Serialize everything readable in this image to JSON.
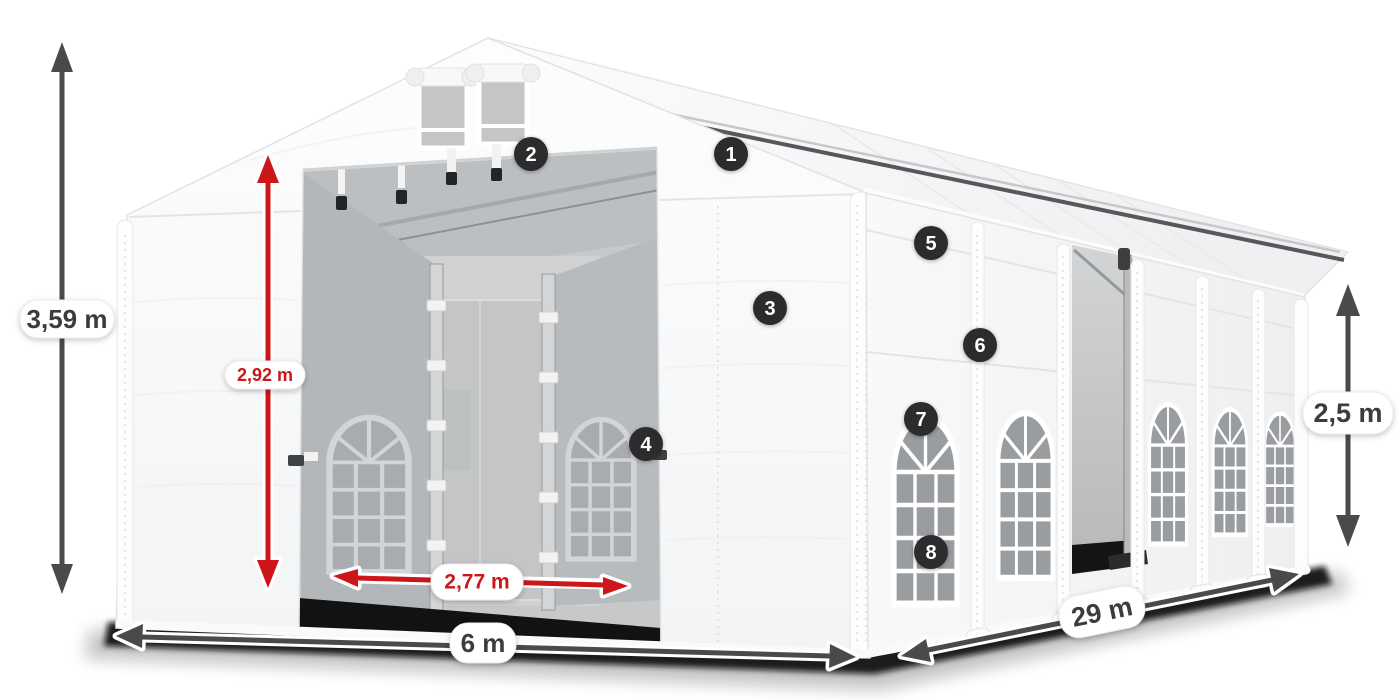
{
  "colors": {
    "accent-red": "#cc1619",
    "dim-dark": "#4a4a4d",
    "label-text": "#3c3c3c",
    "callout-bg": "#2c2c2e",
    "callout-text": "#ffffff",
    "glass-grey": "#9a9da0",
    "interior-grey": "#b7babc",
    "tent-white": "#ffffff",
    "shadow-black": "#111111"
  },
  "dimensions": {
    "total_height": {
      "label": "3,59 m"
    },
    "door_height": {
      "label": "2,92 m"
    },
    "door_width": {
      "label": "2,77 m"
    },
    "front_width": {
      "label": "6 m"
    },
    "length": {
      "label": "29 m"
    },
    "side_height": {
      "label": "2,5 m"
    }
  },
  "callouts": [
    {
      "label": "1"
    },
    {
      "label": "2"
    },
    {
      "label": "3"
    },
    {
      "label": "4"
    },
    {
      "label": "5"
    },
    {
      "label": "6"
    },
    {
      "label": "7"
    },
    {
      "label": "8"
    }
  ]
}
